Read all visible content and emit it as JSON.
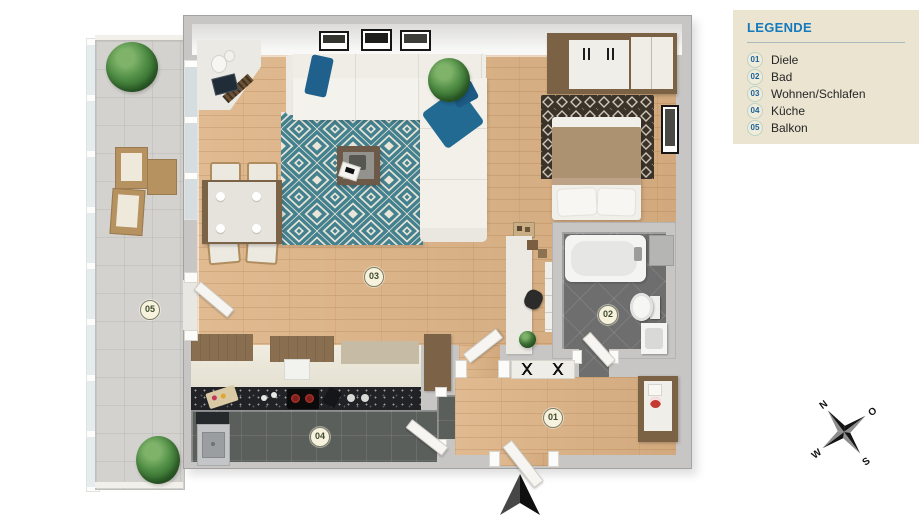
{
  "legend": {
    "title": "LEGENDE",
    "items": [
      {
        "num": "01",
        "label": "Diele"
      },
      {
        "num": "02",
        "label": "Bad"
      },
      {
        "num": "03",
        "label": "Wohnen/Schlafen"
      },
      {
        "num": "04",
        "label": "Küche"
      },
      {
        "num": "05",
        "label": "Balkon"
      }
    ]
  },
  "compass": {
    "north": "N",
    "east": "O",
    "south": "S",
    "west": "W"
  },
  "icons": {
    "entrance": "entrance-arrow",
    "compass": "compass-rose"
  },
  "colors": {
    "legend_bg": "#eae4d1",
    "legend_title_blue": "#1479bd",
    "legend_badge_text": "#16629f",
    "plan_badge_text": "#3f4b2a",
    "wall_gray": "#c7c6c4",
    "wood_floor": "#ddb284",
    "rug_teal": "#44818f",
    "bath_floor": "#6e6e6e",
    "kitchen_floor": "#5b5f5c",
    "pillow_blue": "#226a93",
    "blanket_tan": "#ad9271",
    "balcony_tile": "#d3d2ce"
  }
}
